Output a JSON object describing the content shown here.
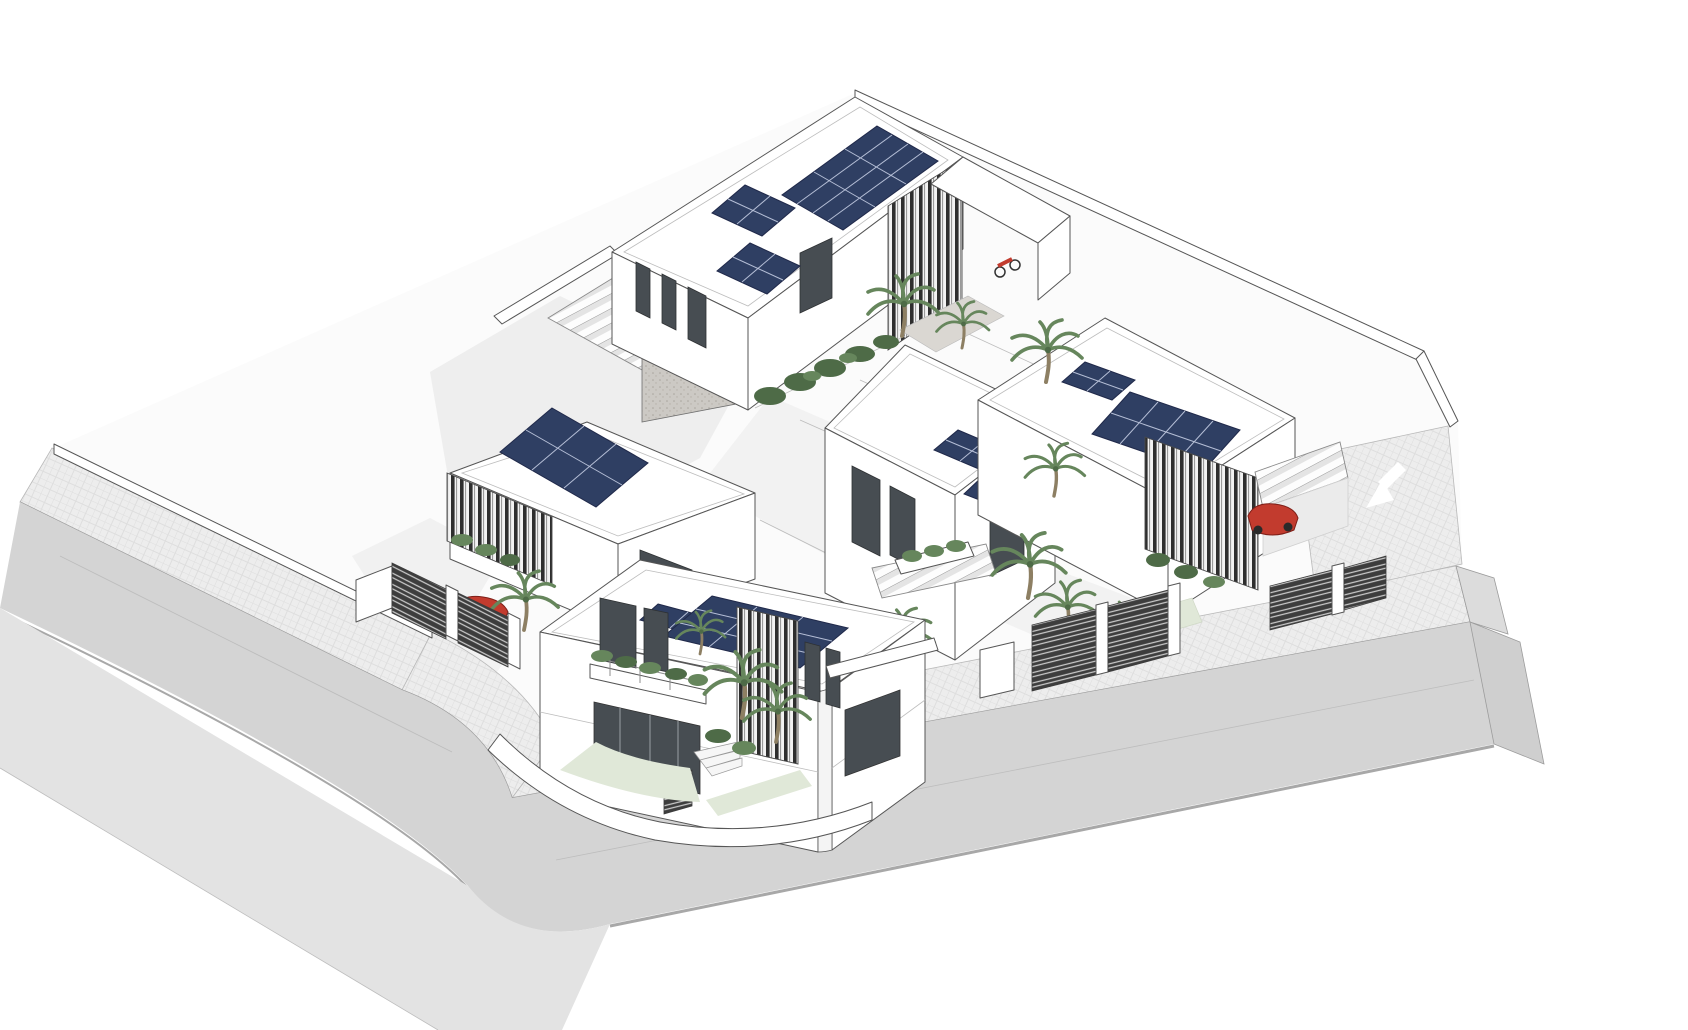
{
  "scene": {
    "view": "3D axonometric site render of a residential villa compound with rooftop solar panels",
    "background": "#ffffff",
    "stats": {
      "villas": 5,
      "solar_arrays": 10,
      "palm_trees": 12,
      "red_cars": 2,
      "red_motorbikes": 1,
      "streets": 2
    },
    "colors": {
      "wall_white": "#ffffff",
      "plot": "#fbfbfb",
      "courtyard": "#f2f2f2",
      "shadow": "#e7e7e7",
      "road": "#d4d4d4",
      "road_edge": "#a8a8a8",
      "sidewalk_outer": "#e3e3e3",
      "sidewalk_inner": "#ededed",
      "curb": "#9c9c9c",
      "solar_panel": "#2f3f63",
      "solar_grid": "#cdd5ea",
      "louver_dark": "#2e2e2e",
      "fence_dark": "#3d3d3d",
      "stucco_gray": "#ccc9c4",
      "glass": "#474d52",
      "lawn": "#e0e8d8",
      "foliage_dark": "#4e6b47",
      "foliage_mid": "#66865c",
      "foliage_trunk": "#8d7f63",
      "car_red": "#c23b2e",
      "car_red_dark": "#7e1f18",
      "pavement_marking": "#ffffff",
      "entry_paving": "#dad7d2"
    },
    "villas": [
      {
        "name": "back-villa",
        "features": [
          "flat roof",
          "three rooftop solar arrays",
          "vertical louver entrance screen",
          "side wing",
          "roof terrace pergola",
          "hedge planter",
          "entrance palm",
          "red motorbike parked at entry"
        ]
      },
      {
        "name": "west-villa",
        "features": [
          "rooftop solar array",
          "curved louver corner screen",
          "carport with red car",
          "street fence gates",
          "front palm tree"
        ]
      },
      {
        "name": "front-villa",
        "features": [
          "two storeys",
          "rounded street corner",
          "two rooftop solar arrays",
          "central louver tower",
          "balcony with planters",
          "curved garden wall",
          "garden palms",
          "entry steps and gate"
        ]
      },
      {
        "name": "middle-villa",
        "features": [
          "two tilted rooftop solar arrays",
          "balcony planter",
          "dark framed windows",
          "slatted pergola to garden"
        ]
      },
      {
        "name": "east-villa",
        "features": [
          "large sloped solar array",
          "small solar array",
          "wrap-around louver facade",
          "slatted carport with red car",
          "driveway with white turn arrow",
          "street fence gates",
          "garden palms"
        ]
      }
    ],
    "streets": [
      {
        "name": "west-street",
        "runs": "diagonally from upper-left to lower-center",
        "parts": [
          "inner cross-hatched sidewalk",
          "asphalt roadway",
          "outer sidewalk"
        ]
      },
      {
        "name": "south-street",
        "runs": "diagonally up toward the right edge",
        "parts": [
          "inner cross-hatched sidewalk",
          "asphalt roadway",
          "curb",
          "end slab faces"
        ],
        "marking": "white turn arrow at entrance driveway"
      }
    ],
    "vehicles": [
      {
        "type": "car",
        "color": "red",
        "location": "west-villa carport"
      },
      {
        "type": "car",
        "color": "red",
        "location": "east-villa carport"
      },
      {
        "type": "motorbike",
        "color": "red",
        "location": "back-villa entrance"
      }
    ]
  }
}
